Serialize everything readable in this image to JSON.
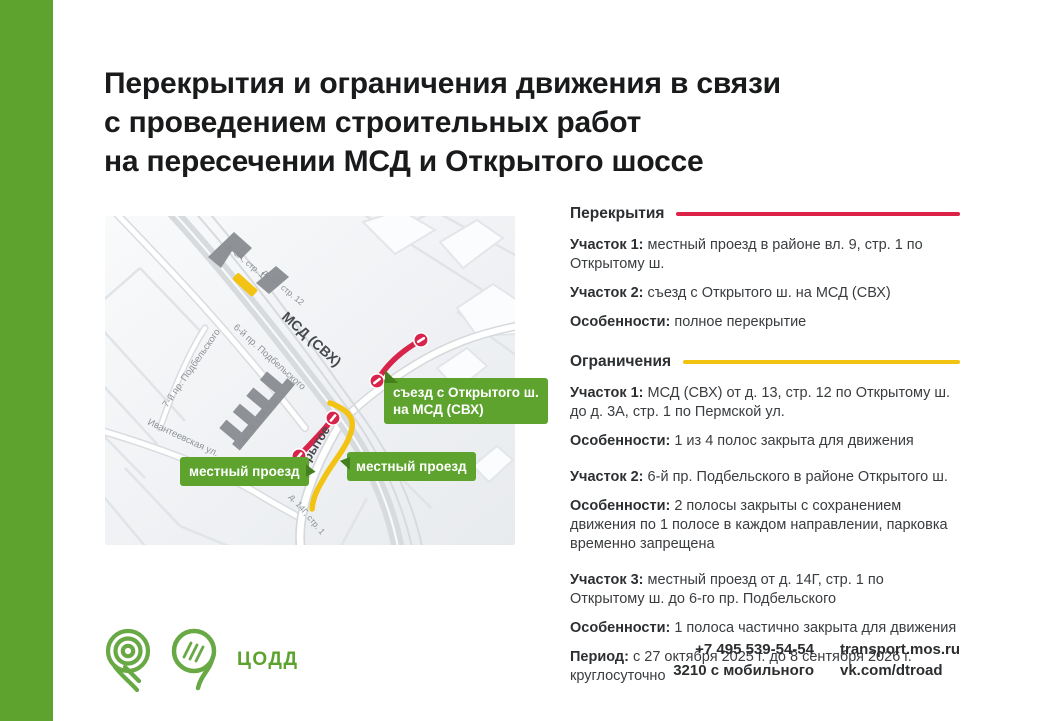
{
  "colors": {
    "green": "#5da32e",
    "dark_green": "#457f1e",
    "red": "#dd2248",
    "map_red": "#d8234a",
    "yellow": "#f3c313"
  },
  "title": {
    "lines": [
      "Перекрытия и ограничения движения в связи",
      "с проведением строительных работ",
      "на пересечении МСД и Открытого шоссе"
    ]
  },
  "map": {
    "roads": {
      "msd": "МСД (СВХ)",
      "otkrytoe": "Открытое ш.",
      "podbelskogo6": "6-й пр. Подбельского",
      "podbelskogo7": "7-й пр. Подбельского",
      "ivanteevskaya": "Ивантеевская ул."
    },
    "buildings": {
      "d3a": "д. 3А, стр. 1",
      "d13": "д. 13, стр. 12",
      "vl9": "вл. 9, стр. 1",
      "d14g": "д. 14Г, стр. 1"
    },
    "callouts": {
      "ramp_line1": "съезд с Открытого ш.",
      "ramp_line2": "на МСД (СВХ)",
      "local_left": "местный проезд",
      "local_right": "местный проезд"
    },
    "legend": {
      "red_meaning": "полное перекрытие",
      "yellow_meaning": "ограничение движения",
      "no_entry_icon": "no-entry-sign"
    }
  },
  "sections": {
    "closures": {
      "heading": "Перекрытия",
      "items": [
        {
          "label": "Участок 1:",
          "text": "местный проезд в районе вл. 9, стр. 1 по Открытому ш."
        },
        {
          "label": "Участок 2:",
          "text": "съезд с Открытого ш. на МСД (СВХ)"
        },
        {
          "label": "Особенности:",
          "text": "полное перекрытие"
        }
      ]
    },
    "restrictions": {
      "heading": "Ограничения",
      "items": [
        {
          "label": "Участок 1:",
          "text": "МСД (СВХ) от д. 13, стр. 12 по Открытому ш. до д. 3А, стр. 1 по Пермской ул."
        },
        {
          "label": "Особенности:",
          "text": "1 из 4 полос закрыта для движения"
        },
        {
          "label": "Участок 2:",
          "text": "6-й пр. Подбельского в районе Открытого ш."
        },
        {
          "label": "Особенности:",
          "text": "2 полосы закрыты с сохранением движения по 1 полосе в каждом направлении, парковка временно запрещена"
        },
        {
          "label": "Участок 3:",
          "text": "местный проезд от д. 14Г, стр. 1 по Открытому ш. до 6-го пр. Подбельского"
        },
        {
          "label": "Особенности:",
          "text": "1 полоса частично закрыта для движения"
        },
        {
          "label": "Период:",
          "text": "с 27 октября 2025 г. до 8 сентября 2026 г. круглосуточно"
        }
      ]
    }
  },
  "footer": {
    "brand": "ЦОДД",
    "phone": "+7 495 539-54-54",
    "phone_mobile": "3210 с мобильного",
    "site": "transport.mos.ru",
    "social": "vk.com/dtroad"
  }
}
